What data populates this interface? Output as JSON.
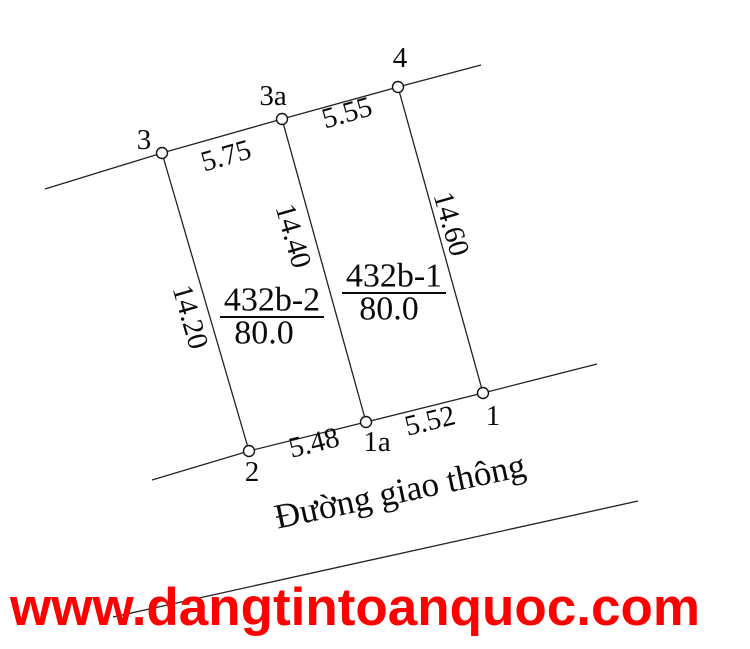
{
  "diagram": {
    "vertices": {
      "v3": "3",
      "v3a": "3a",
      "v4": "4",
      "v2": "2",
      "v1a": "1a",
      "v1": "1"
    },
    "edge_lengths": {
      "top_left": "5.75",
      "top_right": "5.55",
      "left_side": "14.20",
      "middle": "14.40",
      "right_side": "14.60",
      "bottom_left": "5.48",
      "bottom_right": "5.52"
    },
    "parcels": [
      {
        "id": "432b-2",
        "area": "80.0"
      },
      {
        "id": "432b-1",
        "area": "80.0"
      }
    ],
    "road_label": "Đường giao thông"
  },
  "watermark": {
    "text": "www.dangtintoanquoc.com",
    "color": "#fe0000"
  },
  "colors": {
    "line": "#222222",
    "text": "#0a0a0a"
  }
}
